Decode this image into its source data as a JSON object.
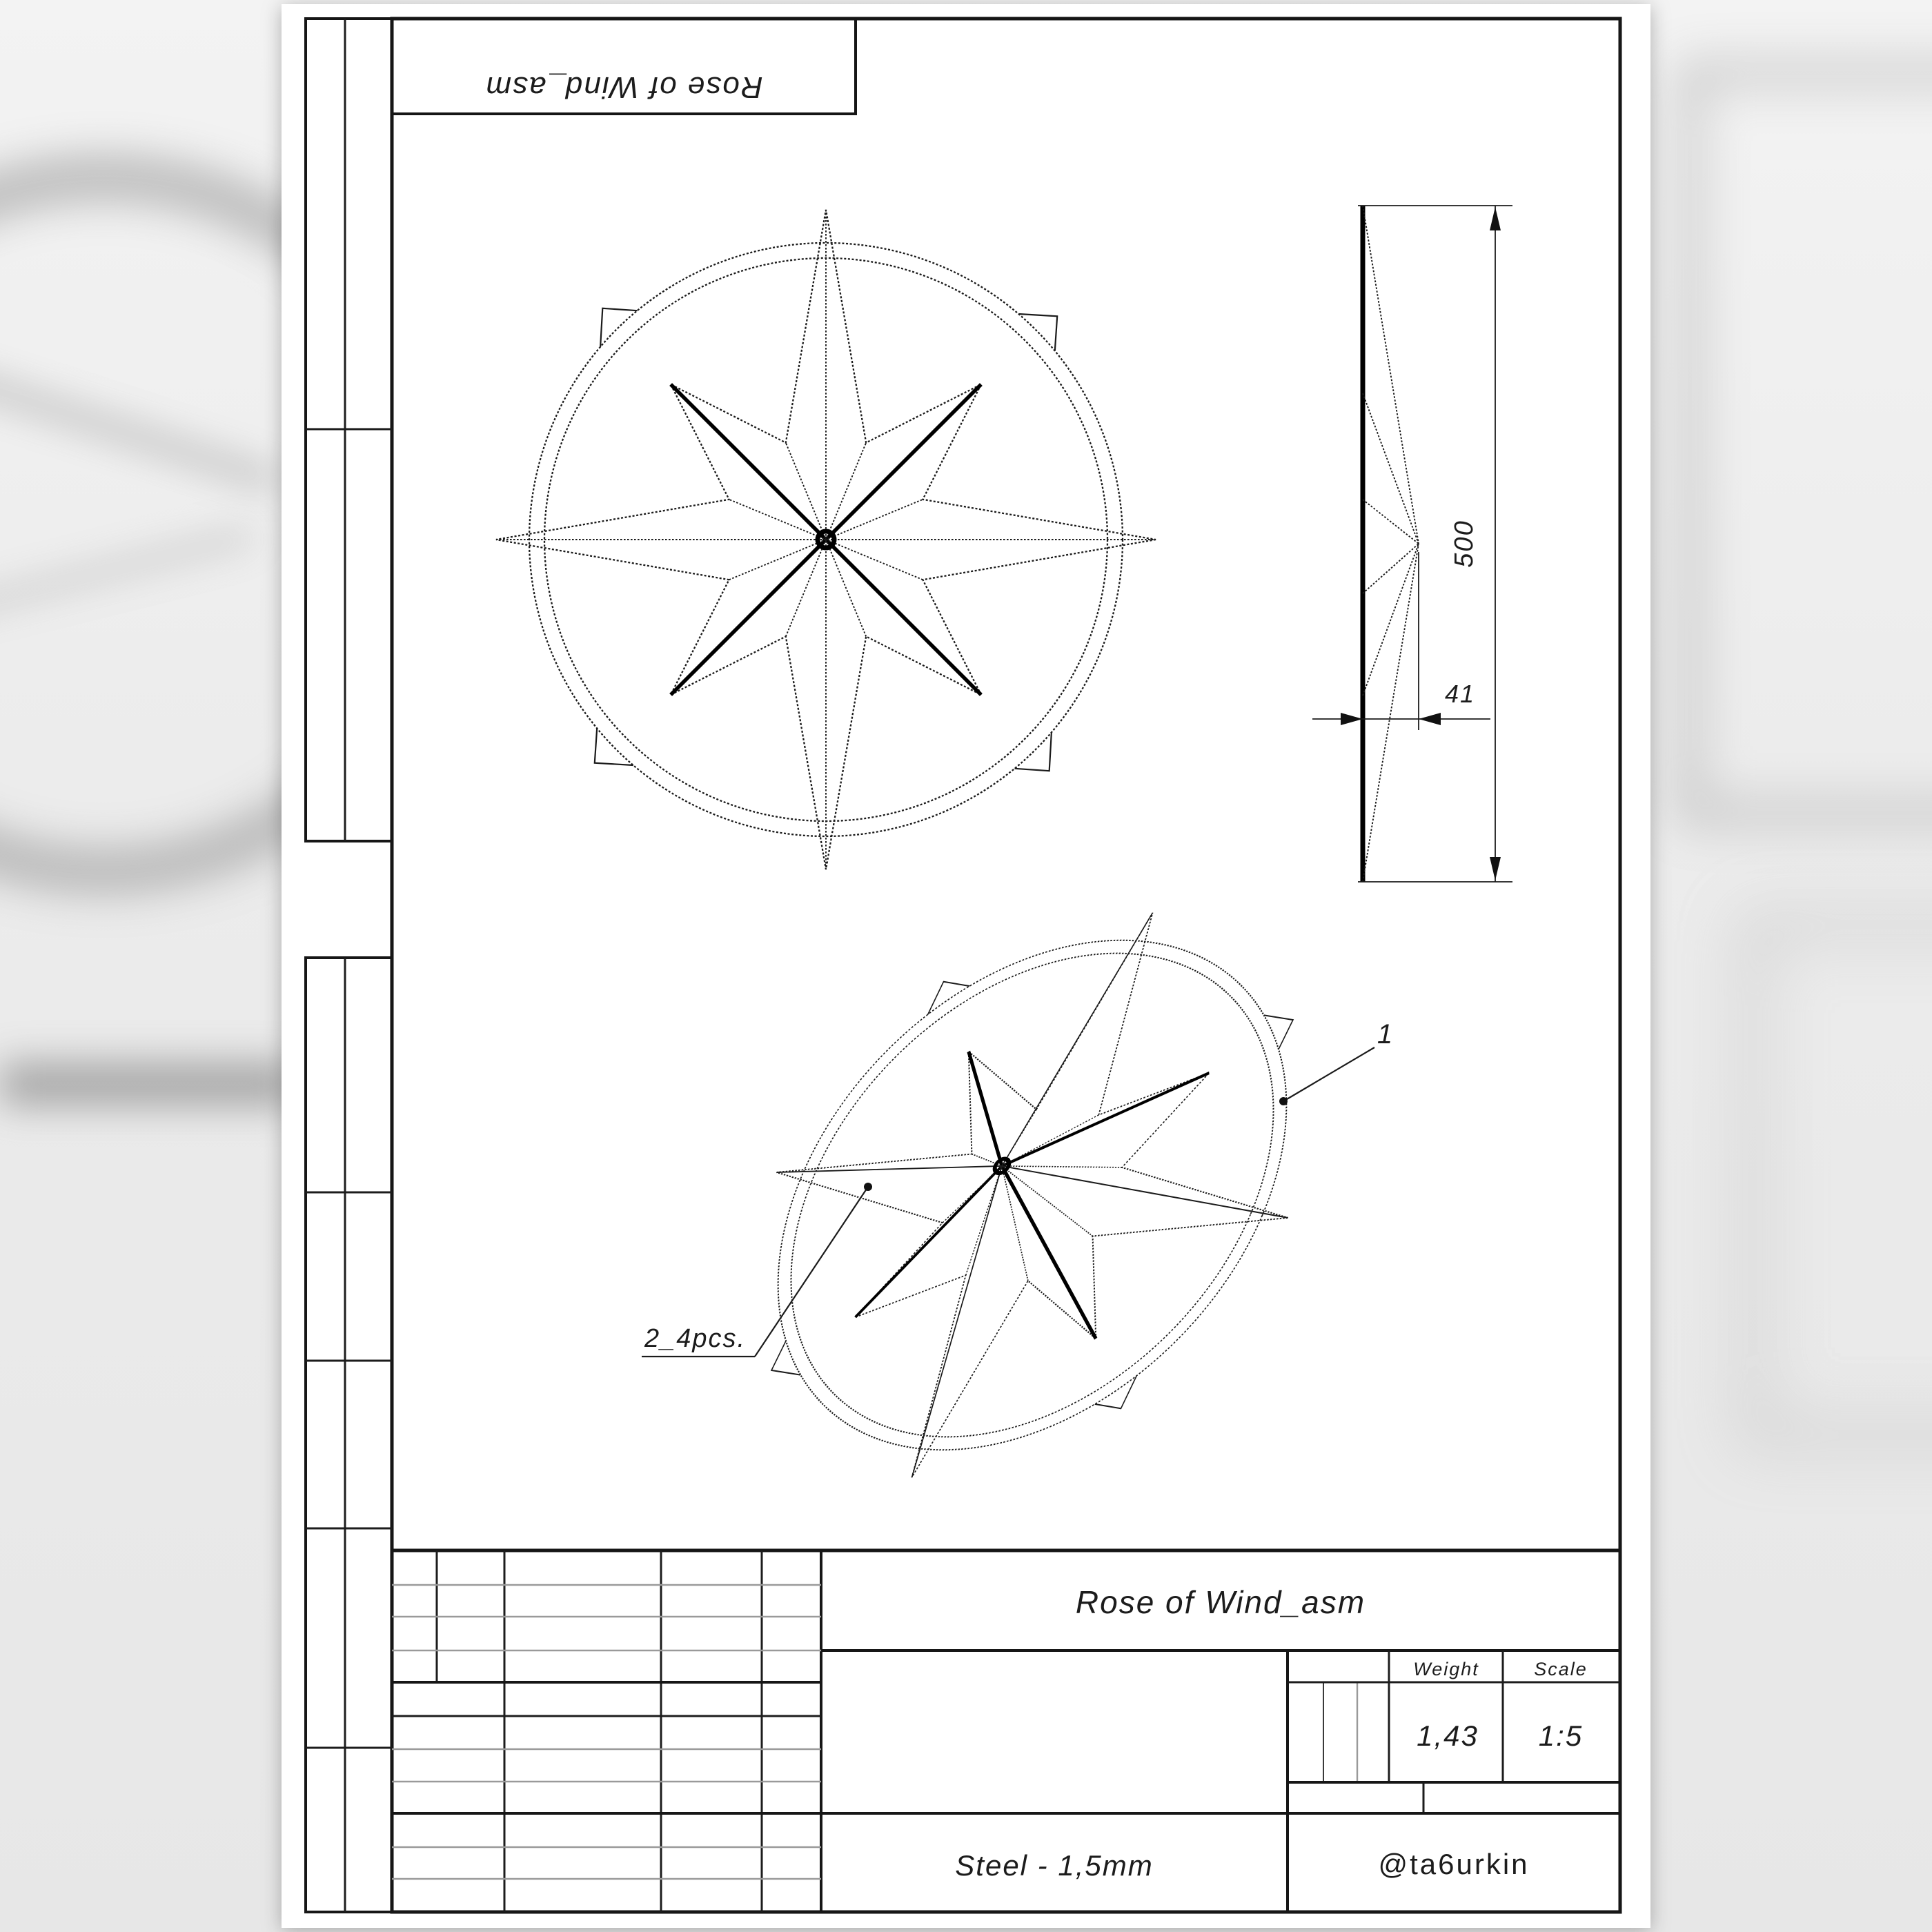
{
  "orientation_label": "Rose of Wind_asm",
  "side_view": {
    "height_dim": "500",
    "thickness_dim": "41"
  },
  "iso_view": {
    "ring_callout": "1",
    "blade_callout": "2_4pcs."
  },
  "title_block": {
    "title": "Rose of Wind_asm",
    "weight_label": "Weight",
    "scale_label": "Scale",
    "weight_value": "1,43",
    "scale_value": "1:5",
    "material": "Steel - 1,5mm",
    "author": "@ta6urkin"
  }
}
